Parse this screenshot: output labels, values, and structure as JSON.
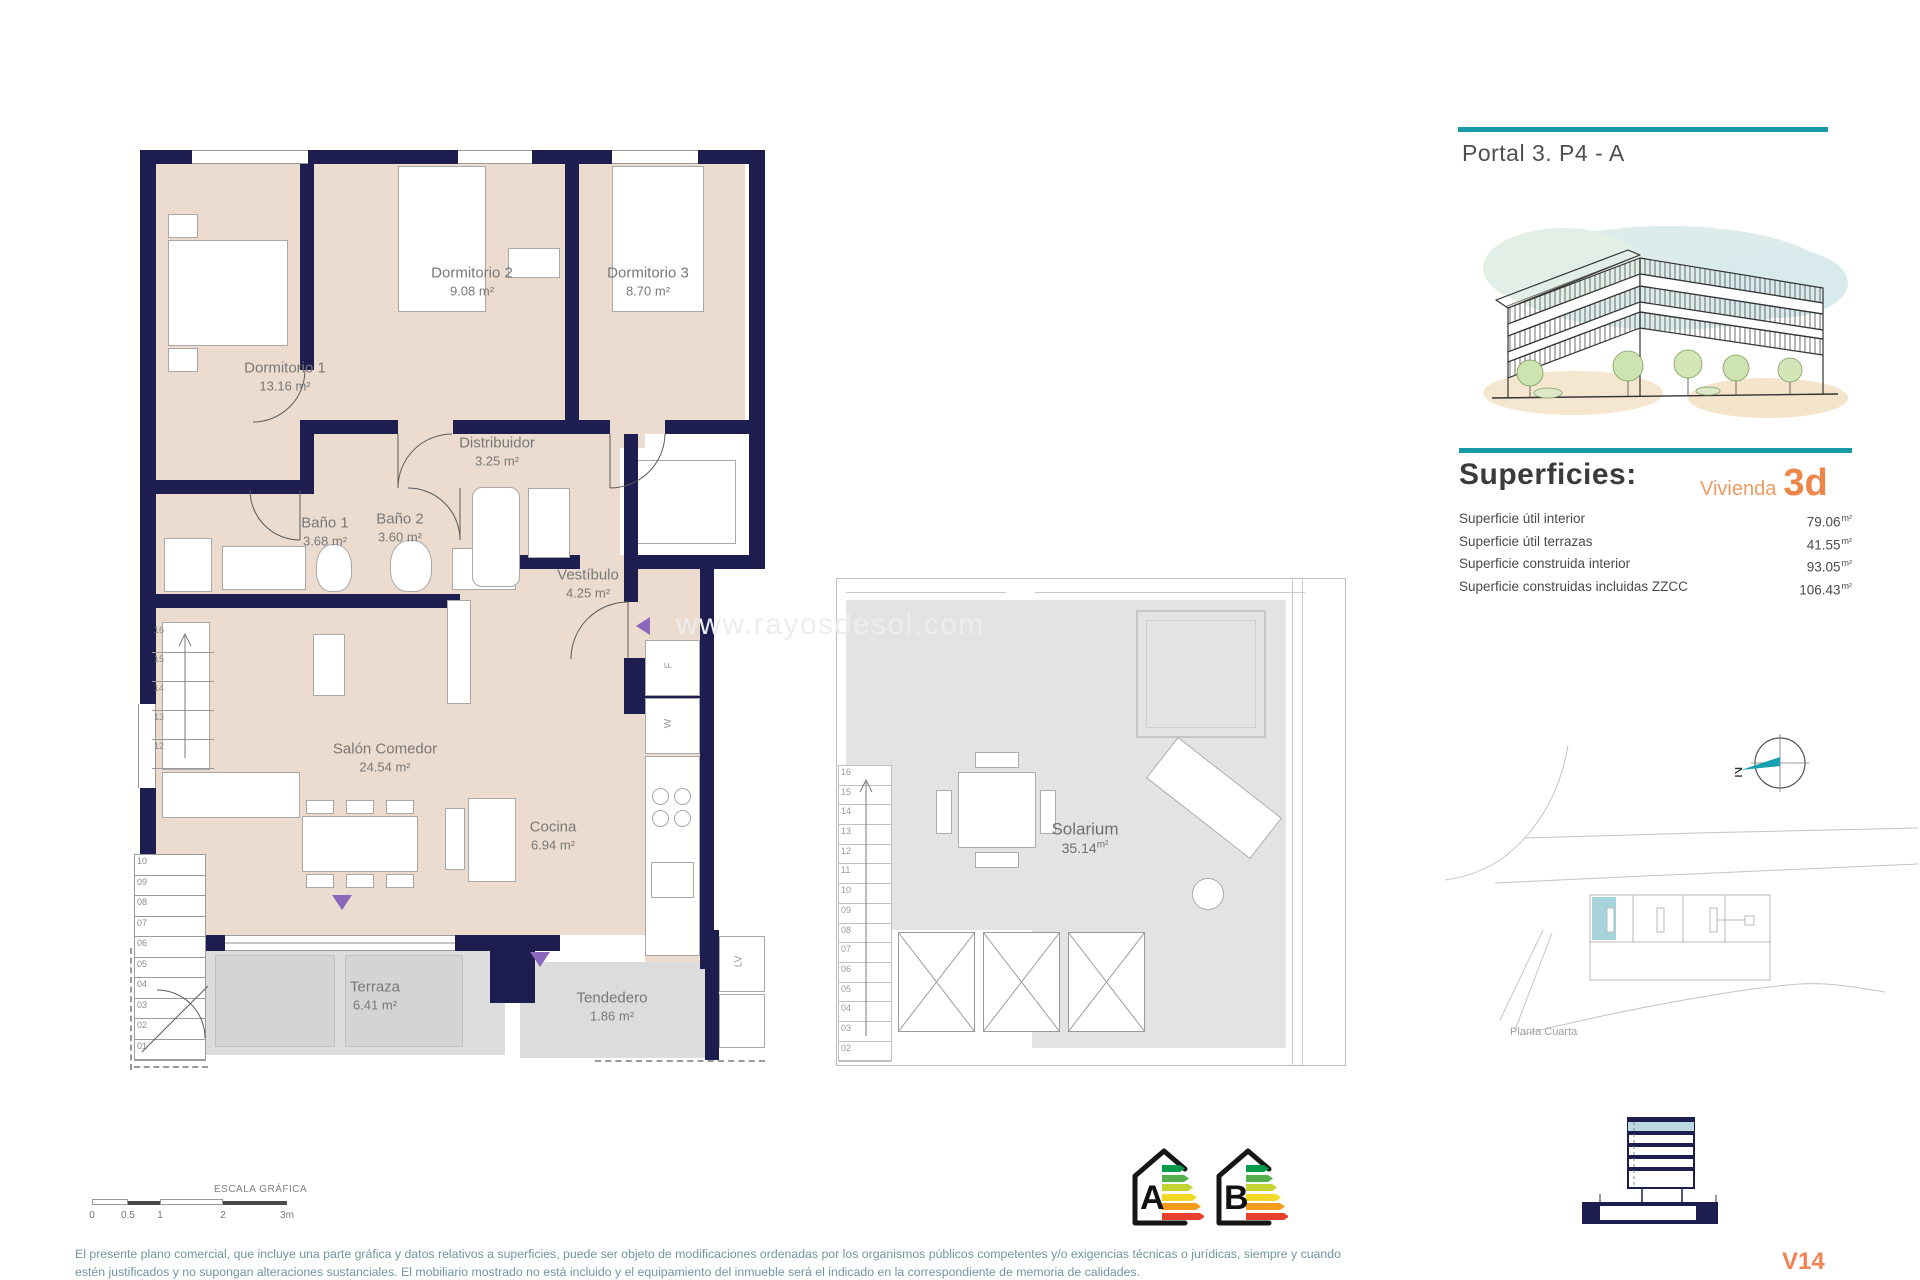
{
  "header": {
    "title": "Portal 3. P4 - A"
  },
  "floor_plan": {
    "rooms": [
      {
        "name": "Dormitorio 1",
        "area": "13.16 m²"
      },
      {
        "name": "Dormitorio 2",
        "area": "9.08 m²"
      },
      {
        "name": "Dormitorio 3",
        "area": "8.70 m²"
      },
      {
        "name": "Distribuidor",
        "area": "3.25 m²"
      },
      {
        "name": "Baño 1",
        "area": "3.68 m²"
      },
      {
        "name": "Baño 2",
        "area": "3.60 m²"
      },
      {
        "name": "Vestíbulo",
        "area": "4.25 m²"
      },
      {
        "name": "Salón Comedor",
        "area": "24.54 m²"
      },
      {
        "name": "Cocina",
        "area": "6.94 m²"
      },
      {
        "name": "Terraza",
        "area": "6.41 m²"
      },
      {
        "name": "Tendedero",
        "area": "1.86 m²"
      }
    ],
    "appliances": {
      "fridge": "F",
      "washer": "W",
      "dishwasher": "LV"
    },
    "stairs_upper": [
      "16",
      "15",
      "14",
      "13",
      "12"
    ],
    "stairs_lower": [
      "10",
      "09",
      "08",
      "07",
      "06",
      "05",
      "04",
      "03",
      "02",
      "01"
    ]
  },
  "solarium": {
    "name": "Solarium",
    "area": "35.14",
    "area_unit": "m²",
    "stairs": [
      "16",
      "15",
      "14",
      "13",
      "12",
      "11",
      "10",
      "09",
      "08",
      "07",
      "06",
      "05",
      "04",
      "03",
      "02"
    ],
    "watermark": "www.rayosdesol.com"
  },
  "superficies": {
    "title": "Superficies:",
    "vivienda_label": "Vivienda",
    "vivienda_code": "3d",
    "rows": [
      {
        "label": "Superficie útil interior",
        "value": "79.06",
        "unit": "m²"
      },
      {
        "label": "Superficie útil terrazas",
        "value": "41.55",
        "unit": "m²"
      },
      {
        "label": "Superficie construida interior",
        "value": "93.05",
        "unit": "m²"
      },
      {
        "label": "Superficie construidas incluidas ZZCC",
        "value": "106.43",
        "unit": "m²"
      }
    ]
  },
  "site_plan": {
    "caption": "Planta Cuarta"
  },
  "compass": {
    "north_label": "N"
  },
  "scale_bar": {
    "title": "ESCALA GRÁFICA",
    "ticks": [
      "0",
      "0.5",
      "1",
      "2",
      "3m"
    ]
  },
  "energy_labels": [
    "A",
    "B"
  ],
  "footer": {
    "line1": "El presente plano comercial, que incluye una parte gráfica y datos relativos a superficies, puede ser objeto de modificaciones ordenadas por los organismos públicos competentes y/o exigencias técnicas o jurídicas, siempre y cuando",
    "line2": "estén justificados y no supongan alteraciones sustanciales. El mobiliario mostrado no está incluido y el equipamiento del inmueble será el indicado en la correspondiente de memoria de calidades.",
    "version": "V14"
  },
  "colors": {
    "accent_teal": "#1799a6",
    "accent_orange": "#ee8549",
    "wall_navy": "#1d1d4f",
    "room_beige": "#ecdccf",
    "terrace_gray": "#dcdcdc",
    "door_purple": "#8b68bb",
    "unit_highlight": "#a7d3da"
  }
}
